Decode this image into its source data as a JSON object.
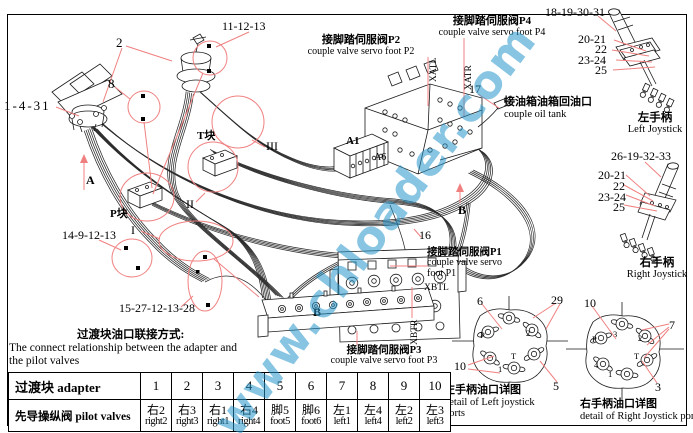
{
  "watermark": "www.chloader.com",
  "colors": {
    "leader_red": "#f08080",
    "watermark_blue": "#2596cb",
    "line_black": "#1a1a1a"
  },
  "callouts": {
    "n11_12_13": "11-12-13",
    "n2": "2",
    "n8": "8",
    "n1_4_31": "1-4-31",
    "n18_19_30_31": "18-19-30-31",
    "n20_21": "20-21",
    "n22": "22",
    "n23_24": "23-24",
    "n25": "25",
    "n26_19_32_33": "26-19-32-33",
    "n14_9_12_13": "14-9-12-13",
    "n15_27_12_13_28": "15-27-12-13-28",
    "n16": "16",
    "n17": "17",
    "n6": "6",
    "n29": "29",
    "n10": "10",
    "n5": "5",
    "n7": "7",
    "n3": "3"
  },
  "annotations": {
    "p2_cn": "接脚踏伺服阀P2",
    "p2_en": "couple valve servo foot P2",
    "p4_cn": "接脚踏伺服阀P4",
    "p4_en": "couple valve servo foot P4",
    "p1_cn": "接脚踏伺服阀P1",
    "p1_en1": "couple valve servo",
    "p1_en2": "foot P1",
    "p3_cn": "接脚踏伺服阀P3",
    "p3_en": "couple valve servo foot P3",
    "tank_cn": "接油箱油箱回油口",
    "tank_en": "couple oil tank",
    "left_joystick_cn": "左手柄",
    "left_joystick_en": "Left Joystick",
    "right_joystick_cn": "右手柄",
    "right_joystick_en": "Right Joystick",
    "xatl": "XATL",
    "xatr": "XATR",
    "xbtl": "XBTL",
    "xbtr": "XBTR",
    "a1": "A1",
    "a6": "A6",
    "t_block": "T块",
    "p_block": "P块",
    "roman_i": "I",
    "roman_ii": "II",
    "roman_iii": "III",
    "dir_a": "A",
    "dir_b": "B"
  },
  "note": {
    "title_cn": "过渡块油口联接方式:",
    "line1": "The connect relationship between the adapter and",
    "line2": "the pilot valves"
  },
  "table": {
    "row1_label": "过渡块 adapter",
    "row2_label": "先导操纵阀 pilot valves",
    "adapters": [
      "1",
      "2",
      "3",
      "4",
      "5",
      "6",
      "7",
      "8",
      "9",
      "10"
    ],
    "valves_cn": [
      "右2",
      "右3",
      "右1",
      "右4",
      "脚5",
      "脚6",
      "左1",
      "左4",
      "左2",
      "左3"
    ],
    "valves_en": [
      "right2",
      "right3",
      "right1",
      "right4",
      "foot5",
      "foot6",
      "left1",
      "left4",
      "left2",
      "left3"
    ]
  },
  "details": {
    "left": {
      "cn": "左手柄油口详图",
      "en1": "detail of Left joystick",
      "en2": "ports",
      "ports": [
        "P",
        "2",
        "1",
        "T"
      ]
    },
    "right": {
      "cn": "右手柄油口详图",
      "en1": "detail of Right Joystick ports",
      "ports": [
        "P",
        "3",
        "2",
        "4",
        "1",
        "T"
      ]
    }
  }
}
